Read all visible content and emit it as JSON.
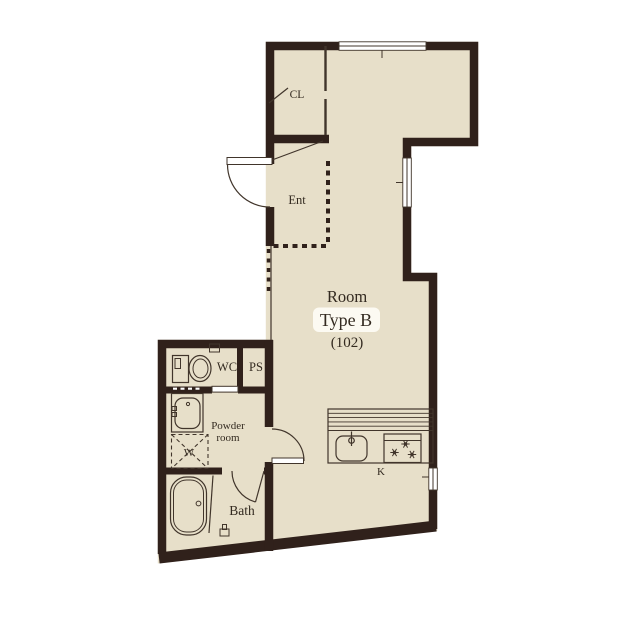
{
  "colors": {
    "wall": "#30211b",
    "floor": "#e7dfc9",
    "line": "#41352b",
    "text": "#332a20",
    "pill": "#fcfaf2",
    "bg": "#ffffff",
    "win": "#ffffff"
  },
  "plan": {
    "room": {
      "label": "Room",
      "type": "Type B",
      "unit": "(102)"
    },
    "areas": {
      "closet": "CL",
      "entrance": "Ent",
      "toilet": "WC",
      "pipe_shaft": "PS",
      "powder_room": [
        "Powder",
        "room"
      ],
      "washer": "W",
      "bathroom": "Bath",
      "kitchen": "K"
    }
  }
}
